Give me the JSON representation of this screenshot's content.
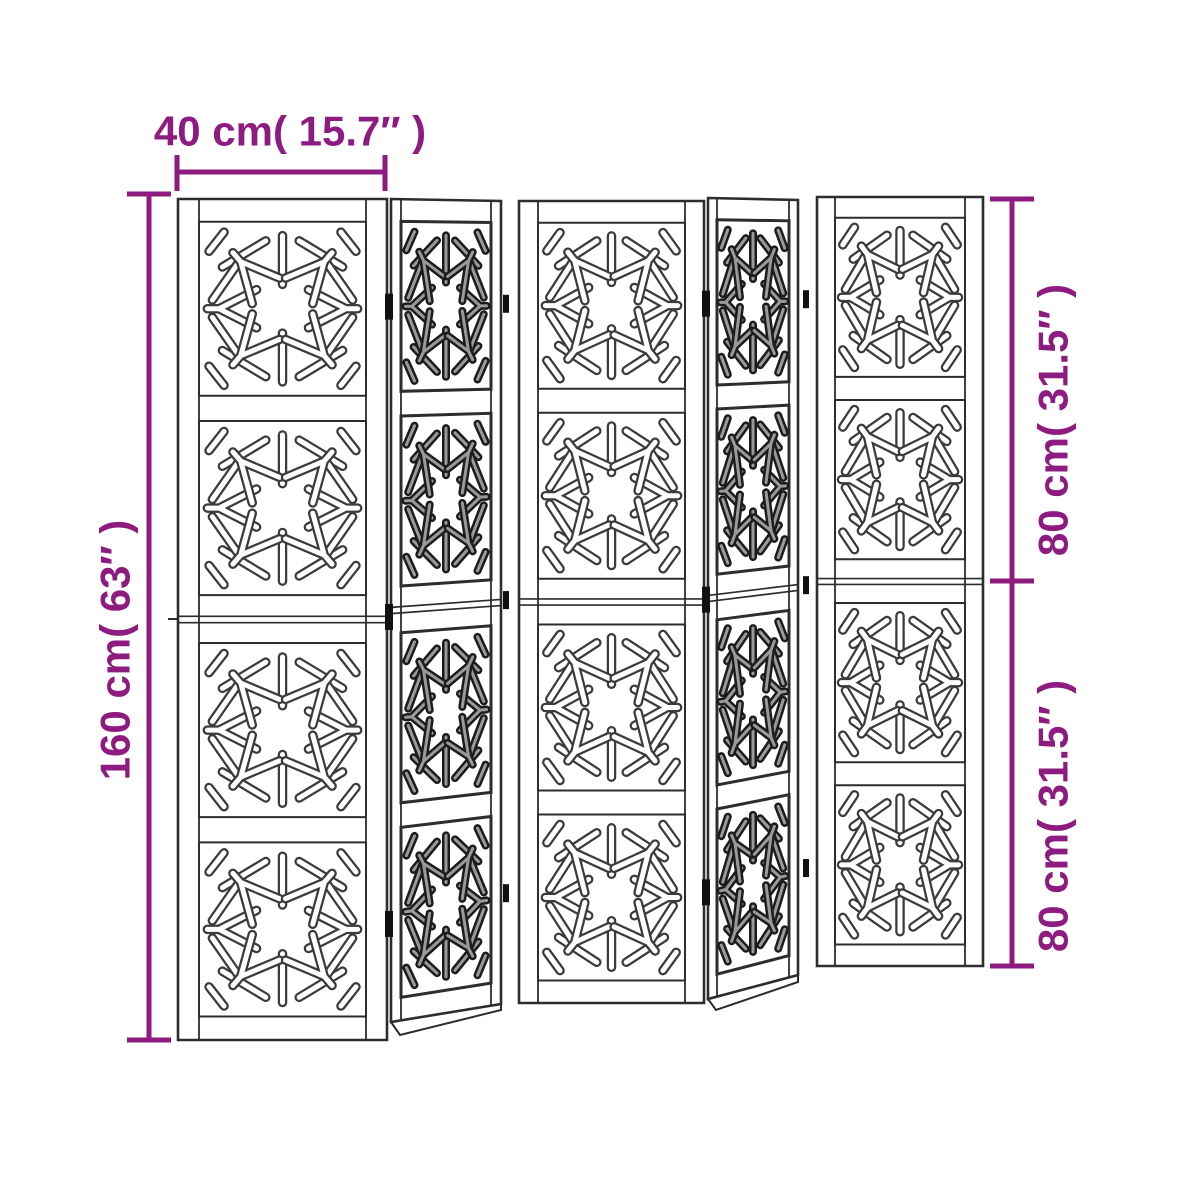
{
  "diagram": {
    "type": "product-dimension-diagram",
    "product": "5-panel folding room divider with snowflake cutout pattern",
    "panels": {
      "count": 5,
      "sections_per_panel": 4,
      "front_facing_panels": [
        1,
        3,
        5
      ],
      "angled_panels": [
        2,
        4
      ],
      "motif": "snowflake-cutout"
    },
    "dimensions": {
      "width_top": "40 cm( 15.7″ )",
      "height_left": "160 cm( 63″ )",
      "height_right_top": "80 cm( 31.5″ )",
      "height_right_bottom": "80 cm( 31.5″ )"
    },
    "colors": {
      "accent": "#8e1c80",
      "line": "#2d2d2d",
      "background": "#ffffff"
    }
  }
}
